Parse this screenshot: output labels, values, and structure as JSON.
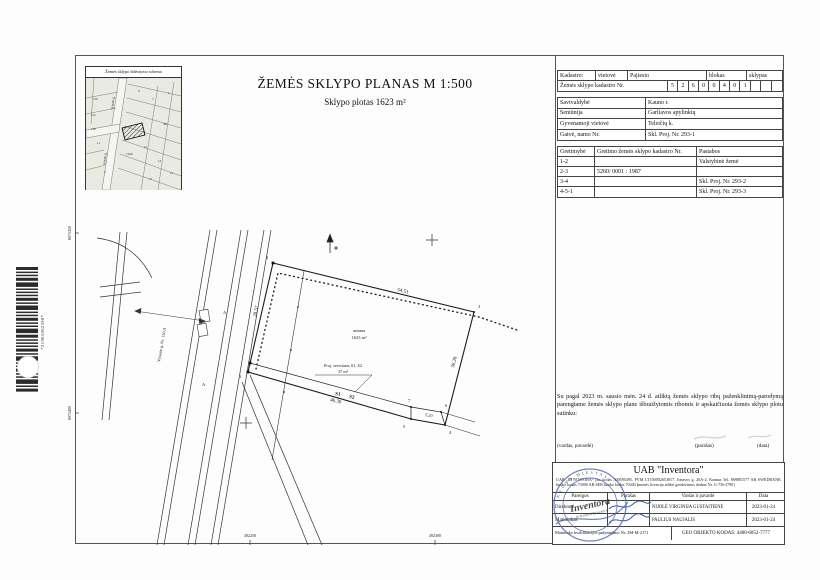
{
  "page": {
    "title_main": "ŽEMĖS SKLYPO PLANAS M 1:500",
    "subtitle": "Sklypo plotas 1623 m²"
  },
  "inset": {
    "title": "Žemės sklypo išdėstymo schema",
    "street_labels": [
      {
        "t": "Vytauto g.",
        "x": 27,
        "y": 32,
        "r": -84
      },
      {
        "t": "Vytauto g.",
        "x": 19,
        "y": 88,
        "r": -84
      }
    ],
    "numbers": [
      {
        "t": "150",
        "x": 7,
        "y": 22
      },
      {
        "t": "152",
        "x": 5,
        "y": 38
      },
      {
        "t": "9",
        "x": 52,
        "y": 14
      },
      {
        "t": "7",
        "x": 66,
        "y": 22
      },
      {
        "t": "5",
        "x": 82,
        "y": 16
      },
      {
        "t": "301",
        "x": 77,
        "y": 47
      },
      {
        "t": "12",
        "x": 58,
        "y": 70
      },
      {
        "t": "14",
        "x": 72,
        "y": 84
      },
      {
        "t": "150A",
        "x": 40,
        "y": 77
      },
      {
        "t": "11",
        "x": 11,
        "y": 66
      },
      {
        "t": "3",
        "x": 18,
        "y": 95
      },
      {
        "t": "17",
        "x": 63,
        "y": 102
      },
      {
        "t": "21",
        "x": 84,
        "y": 96
      },
      {
        "t": "148",
        "x": 5,
        "y": 52
      }
    ]
  },
  "cadastre": {
    "row1": {
      "c1": "Kadastro:",
      "c2": "vietovė",
      "c3": "Pajiesio",
      "c4": "blokas",
      "c5": "sklypas"
    },
    "row2_label": "Žemės sklypo kadastro Nr.",
    "digits": [
      "5",
      "2",
      "6",
      "0",
      "0",
      "4",
      "0",
      "1"
    ]
  },
  "location_table": {
    "rows": [
      {
        "label": "Savivaldybė",
        "value": "Kauno r."
      },
      {
        "label": "Seniūnija",
        "value": "Garliavos apylinkių"
      },
      {
        "label": "Gyvenamoji vietovė",
        "value": "Teleičių k."
      },
      {
        "label": "Gatvė, namo Nr.",
        "value": "Skl. Proj. Nr. 293-1"
      }
    ]
  },
  "adjacency_table": {
    "headers": [
      "Gretimybė",
      "Gretimo žemės sklypo kadastro Nr.",
      "Pastabos"
    ],
    "rows": [
      {
        "id": "1-2",
        "cad": "",
        "note": "Valstybinė žemė"
      },
      {
        "id": "2-3",
        "cad": "5260/ 0001 : 1987",
        "note": ""
      },
      {
        "id": "3-4",
        "cad": "",
        "note": "Skl. Proj. Nr. 293-2"
      },
      {
        "id": "4-5-1",
        "cad": "",
        "note": "Skl. Proj. Nr. 293-3"
      }
    ]
  },
  "consent_text": "Su pagal 2023 m. sausio mėn. 24 d. atliktą žemės sklypo ribų paženklinimą-parodymą parengtame žemės sklypo plane išbraižytomis ribomis ir apskaičiuota žemės sklypo plotu sutinku:",
  "signature_row": {
    "name_label": "(vardas, pavardė)",
    "sign_label": "(parašas)",
    "date_label": "(data)"
  },
  "company_block": {
    "title": "UAB \"Inventora\"",
    "info_line": "UAB „INVENTORA“ Įm. kodas 300595495, PVM LT100002653817, Jonavos g. 26A-2, Kaunas Tel. 869881577 AB SWEDBANK banko kodas 73000 AB SEB banko kodas 70440 Įmonės licencija atlikti geodezinius darbus Nr. G-736-(790)",
    "table": {
      "headers": {
        "role": "Pareigos",
        "sign": "Parašas",
        "name": "Vardas ir pavardė",
        "date": "Data"
      },
      "rows": [
        {
          "role": "Direktorė",
          "name": "NIJOLĖ VIRGINIJA GUSTAITIENĖ",
          "date": "2023-01-24"
        },
        {
          "role": "Matininkas",
          "name": "PAULIUS NAUJALIS",
          "date": "2023-01-24"
        }
      ]
    },
    "footer_left": "Matininko kvalifikacijos pažymėjimo Nr. 2M-M-2171",
    "footer_right": "GEO OBJEKTO KODAS: 4400-6052-7777"
  },
  "stamp": {
    "center": "Inventora",
    "sub": "DOKUMENTŲ KOPIJA",
    "arc_top": "KAUNO MIESTAS"
  },
  "barcode": {
    "text": "*21965062598*"
  },
  "drawing": {
    "labels": [
      {
        "t": "54.53",
        "x": 322,
        "y": 236,
        "r": 13,
        "s": 5
      },
      {
        "t": "28.57",
        "x": 181,
        "y": 262,
        "r": -77,
        "s": 5
      },
      {
        "t": "30.28",
        "x": 379,
        "y": 313,
        "r": -76,
        "s": 5
      },
      {
        "t": "46.30",
        "x": 255,
        "y": 346,
        "r": 13,
        "s": 5
      },
      {
        "t": "5.20",
        "x": 350,
        "y": 361,
        "r": 10,
        "s": 4.3
      },
      {
        "t": "ariama",
        "x": 284,
        "y": 277,
        "s": 4.5,
        "a": "middle"
      },
      {
        "t": "1623 m²",
        "x": 284,
        "y": 284,
        "s": 4.5,
        "a": "middle"
      },
      {
        "t": "Proj. servitutas S1, S2",
        "x": 268,
        "y": 312,
        "s": 4.3,
        "a": "middle"
      },
      {
        "t": "37 m²",
        "x": 268,
        "y": 318,
        "s": 4.3,
        "a": "middle"
      },
      {
        "t": "S1",
        "x": 260,
        "y": 340,
        "r": 9,
        "s": 5,
        "w": "bold"
      },
      {
        "t": "S2",
        "x": 274,
        "y": 343,
        "r": 9,
        "s": 5,
        "w": "bold"
      },
      {
        "t": "1",
        "x": 164,
        "y": 323,
        "s": 4.5
      },
      {
        "t": "2",
        "x": 191,
        "y": 204,
        "s": 4.5
      },
      {
        "t": "3",
        "x": 403,
        "y": 253,
        "s": 4.5
      },
      {
        "t": "4",
        "x": 374,
        "y": 379,
        "s": 4.5
      },
      {
        "t": "5",
        "x": 328,
        "y": 373,
        "s": 4.5
      },
      {
        "t": "6",
        "x": 370,
        "y": 352,
        "s": 4.5
      },
      {
        "t": "7",
        "x": 333,
        "y": 347,
        "s": 4.5
      },
      {
        "t": "A",
        "x": 148,
        "y": 259,
        "s": 4.5
      },
      {
        "t": "A",
        "x": 127,
        "y": 331,
        "s": 4.5
      },
      {
        "t": "Vytauto g. Nr. 150 A",
        "x": 88,
        "y": 290,
        "r": -80,
        "s": 4.2,
        "a": "middle"
      },
      {
        "t": "6075450",
        "x": -4,
        "y": 178,
        "r": -90,
        "s": 4,
        "a": "middle"
      },
      {
        "t": "6075400",
        "x": -4,
        "y": 358,
        "r": -90,
        "s": 4,
        "a": "middle"
      },
      {
        "t": "492250",
        "x": 175,
        "y": 482,
        "s": 4,
        "a": "middle"
      },
      {
        "t": "492300",
        "x": 360,
        "y": 482,
        "s": 4,
        "a": "middle"
      }
    ]
  }
}
